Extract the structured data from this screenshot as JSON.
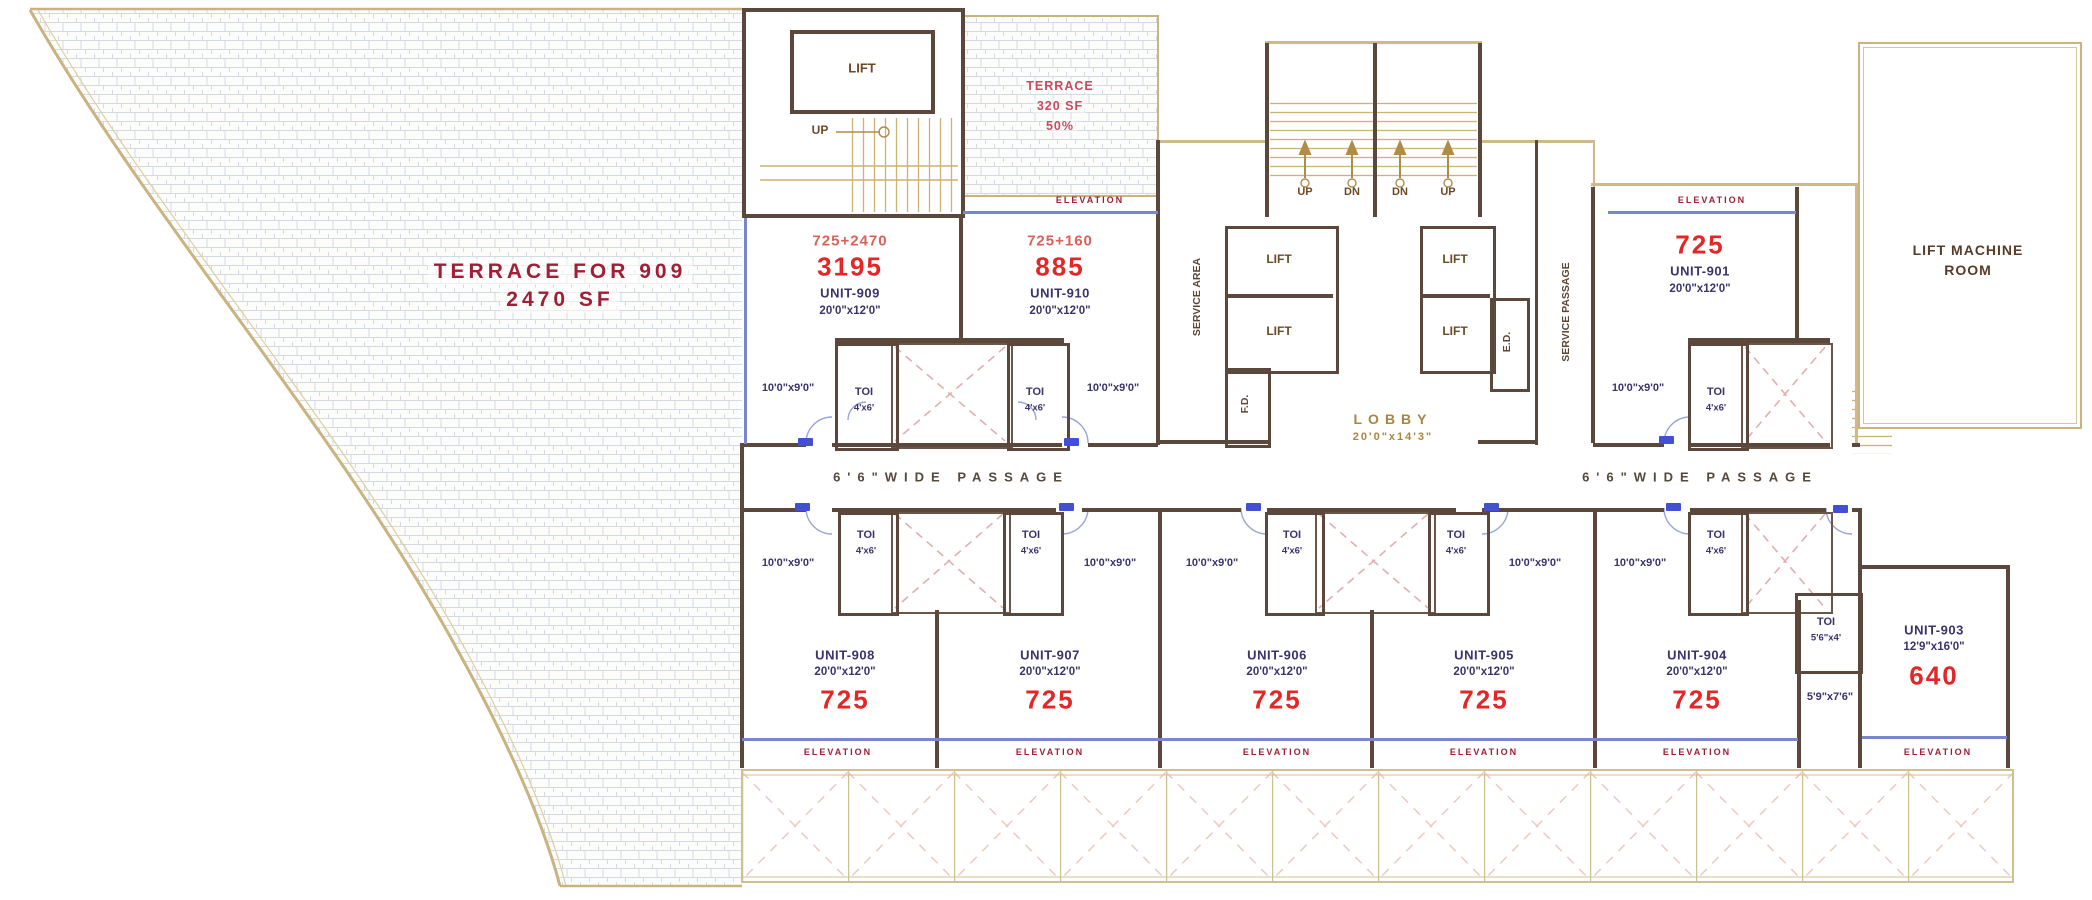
{
  "terraces": {
    "left_line1": "TERRACE FOR 909",
    "left_line2": "2470 SF",
    "top_line1": "TERRACE",
    "top_line2": "320 SF",
    "top_line3": "50%"
  },
  "labels": {
    "elevation": "ELEVATION",
    "toi": "TOI",
    "toi_dim": "4'x6'",
    "toi_dim_alt": "5'6\"x4'",
    "lobby_903_dim": "5'9\"x7'6\"",
    "balcony_dim": "10'0\"x9'0\"",
    "passage": "6'6\"WIDE PASSAGE",
    "up": "UP",
    "dn": "DN",
    "lift": "LIFT",
    "service_area": "SERVICE AREA",
    "service_passage": "SERVICE PASSAGE",
    "fd": "F.D.",
    "ed": "E.D.",
    "lobby": "LOBBY",
    "lobby_dim": "20'0\"x14'3\"",
    "lift_machine_line1": "LIFT MACHINE",
    "lift_machine_line2": "ROOM"
  },
  "units": {
    "u909": {
      "sum": "725+2470",
      "area": "3195",
      "name": "UNIT-909",
      "dim": "20'0\"x12'0\""
    },
    "u910": {
      "sum": "725+160",
      "area": "885",
      "name": "UNIT-910",
      "dim": "20'0\"x12'0\""
    },
    "u901": {
      "area": "725",
      "name": "UNIT-901",
      "dim": "20'0\"x12'0\""
    },
    "u908": {
      "name": "UNIT-908",
      "dim": "20'0\"x12'0\"",
      "area": "725"
    },
    "u907": {
      "name": "UNIT-907",
      "dim": "20'0\"x12'0\"",
      "area": "725"
    },
    "u906": {
      "name": "UNIT-906",
      "dim": "20'0\"x12'0\"",
      "area": "725"
    },
    "u905": {
      "name": "UNIT-905",
      "dim": "20'0\"x12'0\"",
      "area": "725"
    },
    "u904": {
      "name": "UNIT-904",
      "dim": "20'0\"x12'0\"",
      "area": "725"
    },
    "u903": {
      "name": "UNIT-903",
      "dim": "12'9\"x16'0\"",
      "area": "640"
    }
  },
  "colors": {
    "wall_dark": "#5c473d",
    "wall_beige": "#c9b37e",
    "area_red": "#e52626",
    "sum_salmon": "#dd6057",
    "unit_navy": "#39346a",
    "elevation_red": "#9c2033",
    "terrace_red": "#a01f35",
    "window_blue": "#7b87cc",
    "door_tag_blue": "#4450d4",
    "duct_pink": "#e2aeae",
    "tread_tan": "#cdb175"
  }
}
